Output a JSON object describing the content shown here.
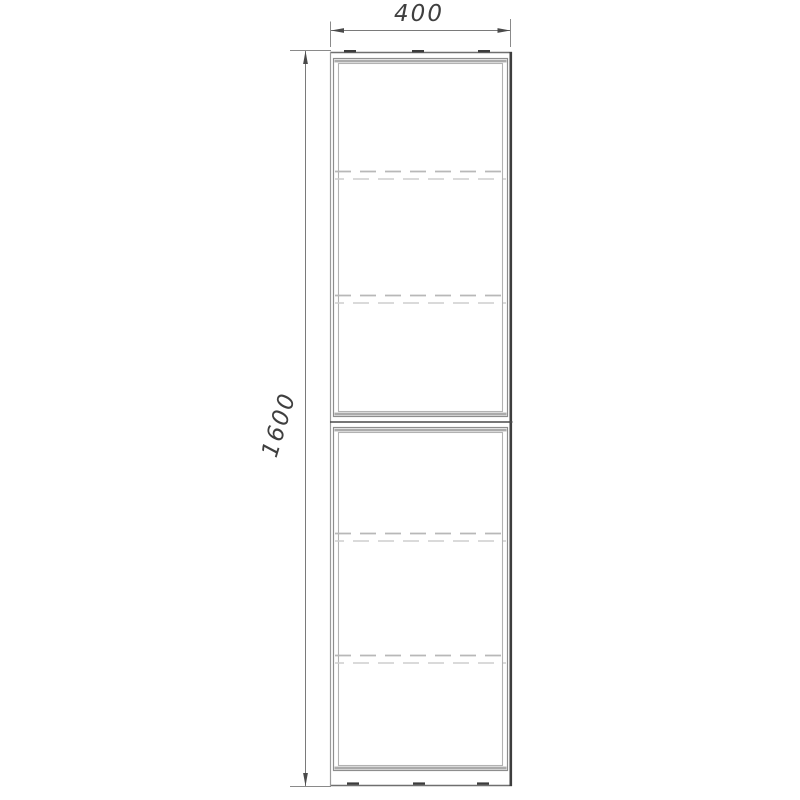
{
  "drawing": {
    "object": "two-door tall cabinet, front elevation with overall dimensions",
    "dimensions": {
      "width": "400",
      "height": "1600"
    },
    "colors": {
      "background": "#ffffff",
      "edge_dark": "#3e3e3e",
      "edge_gray": "#8f8f8f",
      "inner_frame": "#b2b2b2",
      "hidden_shelf_line": "#c0c0c0",
      "dimension_line": "#7a7a7a",
      "dimension_text": "#3f3f3f"
    }
  }
}
